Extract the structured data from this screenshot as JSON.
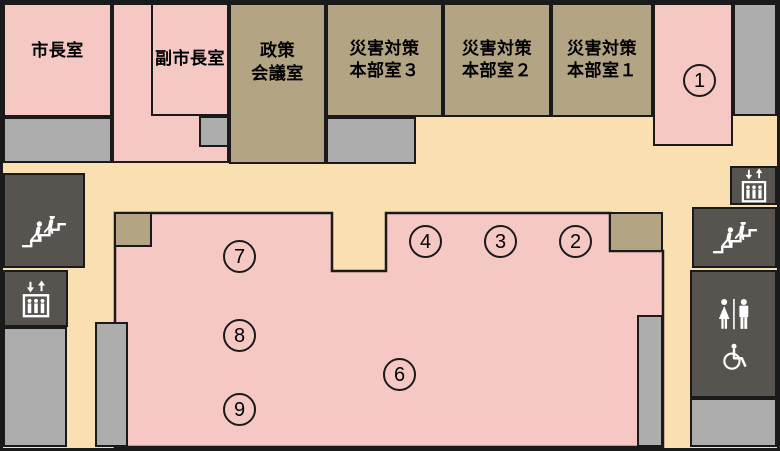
{
  "map": {
    "rooms": {
      "mayor": {
        "label": "市長室"
      },
      "deputy_mayor": {
        "label": "副市長室"
      },
      "policy_meeting": {
        "line1": "政策",
        "line2": "会議室"
      },
      "disaster_hq_3": {
        "line1": "災害対策",
        "line2": "本部室３"
      },
      "disaster_hq_2": {
        "line1": "災害対策",
        "line2": "本部室２"
      },
      "disaster_hq_1": {
        "line1": "災害対策",
        "line2": "本部室１"
      }
    },
    "markers": {
      "m1": "1",
      "m2": "2",
      "m3": "3",
      "m4": "4",
      "m6": "6",
      "m7": "7",
      "m8": "8",
      "m9": "9"
    },
    "icons": {
      "left_stairs": "stairs-icon",
      "left_elevator": "elevator-icon",
      "right_elevator": "elevator-icon",
      "right_stairs": "stairs-icon",
      "restroom": "restroom-icon",
      "wheelchair": "wheelchair-icon"
    },
    "colors": {
      "room_pink": "#F6C8C4",
      "room_tan": "#B3A584",
      "floor_cream": "#FAE0B1",
      "light_gray": "#ADADAD",
      "dark_gray": "#57534F",
      "outline": "#1A1A1A",
      "icon": "#FFFFFF"
    }
  }
}
